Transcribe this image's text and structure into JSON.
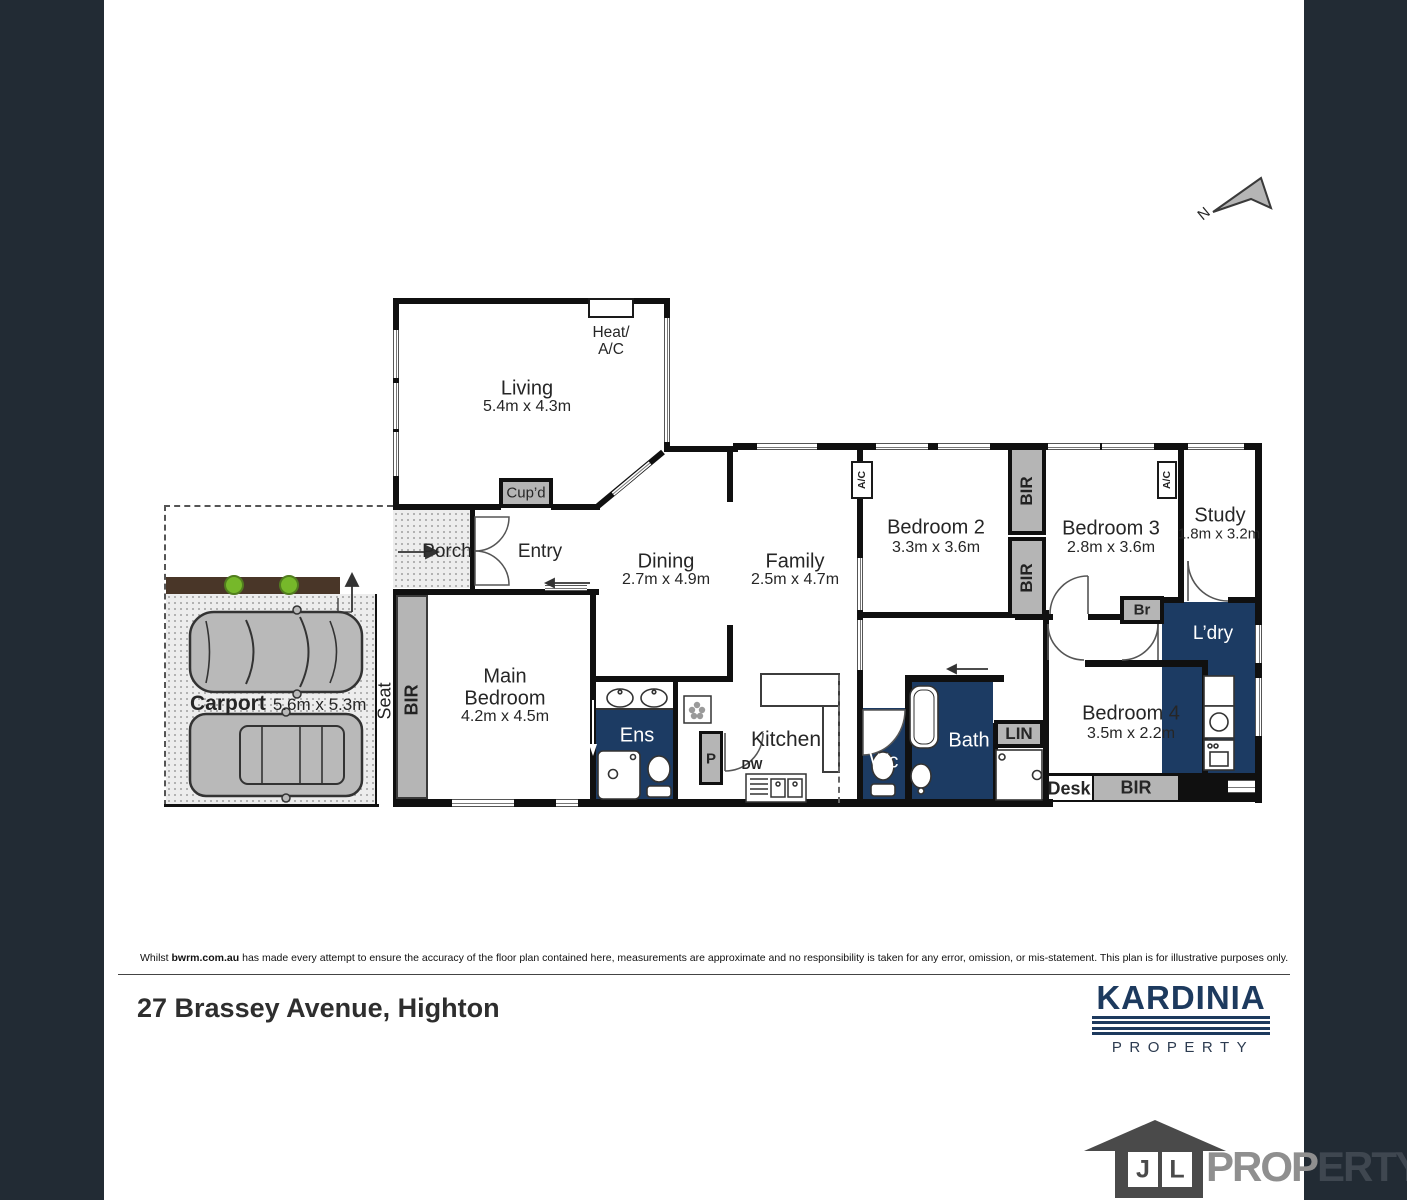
{
  "compass": {
    "north": "N"
  },
  "rooms": {
    "living": {
      "name": "Living",
      "dims": "5.4m x 4.3m"
    },
    "dining": {
      "name": "Dining",
      "dims": "2.7m x 4.9m"
    },
    "family": {
      "name": "Family",
      "dims": "2.5m x 4.7m"
    },
    "kitchen": {
      "name": "Kitchen"
    },
    "main_bedroom": {
      "name_line1": "Main",
      "name_line2": "Bedroom",
      "dims": "4.2m x 4.5m"
    },
    "bedroom2": {
      "name": "Bedroom 2",
      "dims": "3.3m x 3.6m"
    },
    "bedroom3": {
      "name": "Bedroom 3",
      "dims": "2.8m x 3.6m"
    },
    "bedroom4": {
      "name": "Bedroom 4",
      "dims": "3.5m x 2.2m"
    },
    "study": {
      "name": "Study",
      "dims": "1.8m x 3.2m"
    },
    "carport": {
      "name": "Carport",
      "dims": "5.6m x 5.3m"
    },
    "porch": {
      "name": "Porch"
    },
    "entry": {
      "name": "Entry"
    },
    "ens": {
      "name": "Ens"
    },
    "bath": {
      "name": "Bath"
    },
    "wc": {
      "name": "Wc"
    },
    "laundry": {
      "name": "L’dry"
    }
  },
  "fixtures": {
    "heat_ac_line1": "Heat/",
    "heat_ac_line2": "A/C",
    "ac": "A/C",
    "cupboard": "Cup’d",
    "bir": "BIR",
    "seat": "Seat",
    "linen": "LIN",
    "broom": "Br",
    "desk": "Desk",
    "pantry": "P",
    "dishwasher": "DW"
  },
  "footer": {
    "disclaimer_prefix": "Whilst ",
    "disclaimer_brand": "bwrm.com.au",
    "disclaimer_rest": " has made every attempt to ensure the accuracy of the floor plan contained here, measurements are approximate and no responsibility is taken for any error, omission, or mis-statement. This plan is for illustrative purposes only.",
    "address": "27 Brassey Avenue, Highton"
  },
  "branding": {
    "kardinia_name": "KARDINIA",
    "kardinia_tagline": "PROPERTY",
    "jl_letter1": "J",
    "jl_letter2": "L",
    "jl_text_light": "PROP",
    "jl_text_dark": "ERTY"
  },
  "colors": {
    "sidebar": "#222b34",
    "wet_area_navy": "#1c3b63",
    "fixture_gray": "#b5b5b5",
    "kardinia_navy": "#1d3a5e"
  }
}
